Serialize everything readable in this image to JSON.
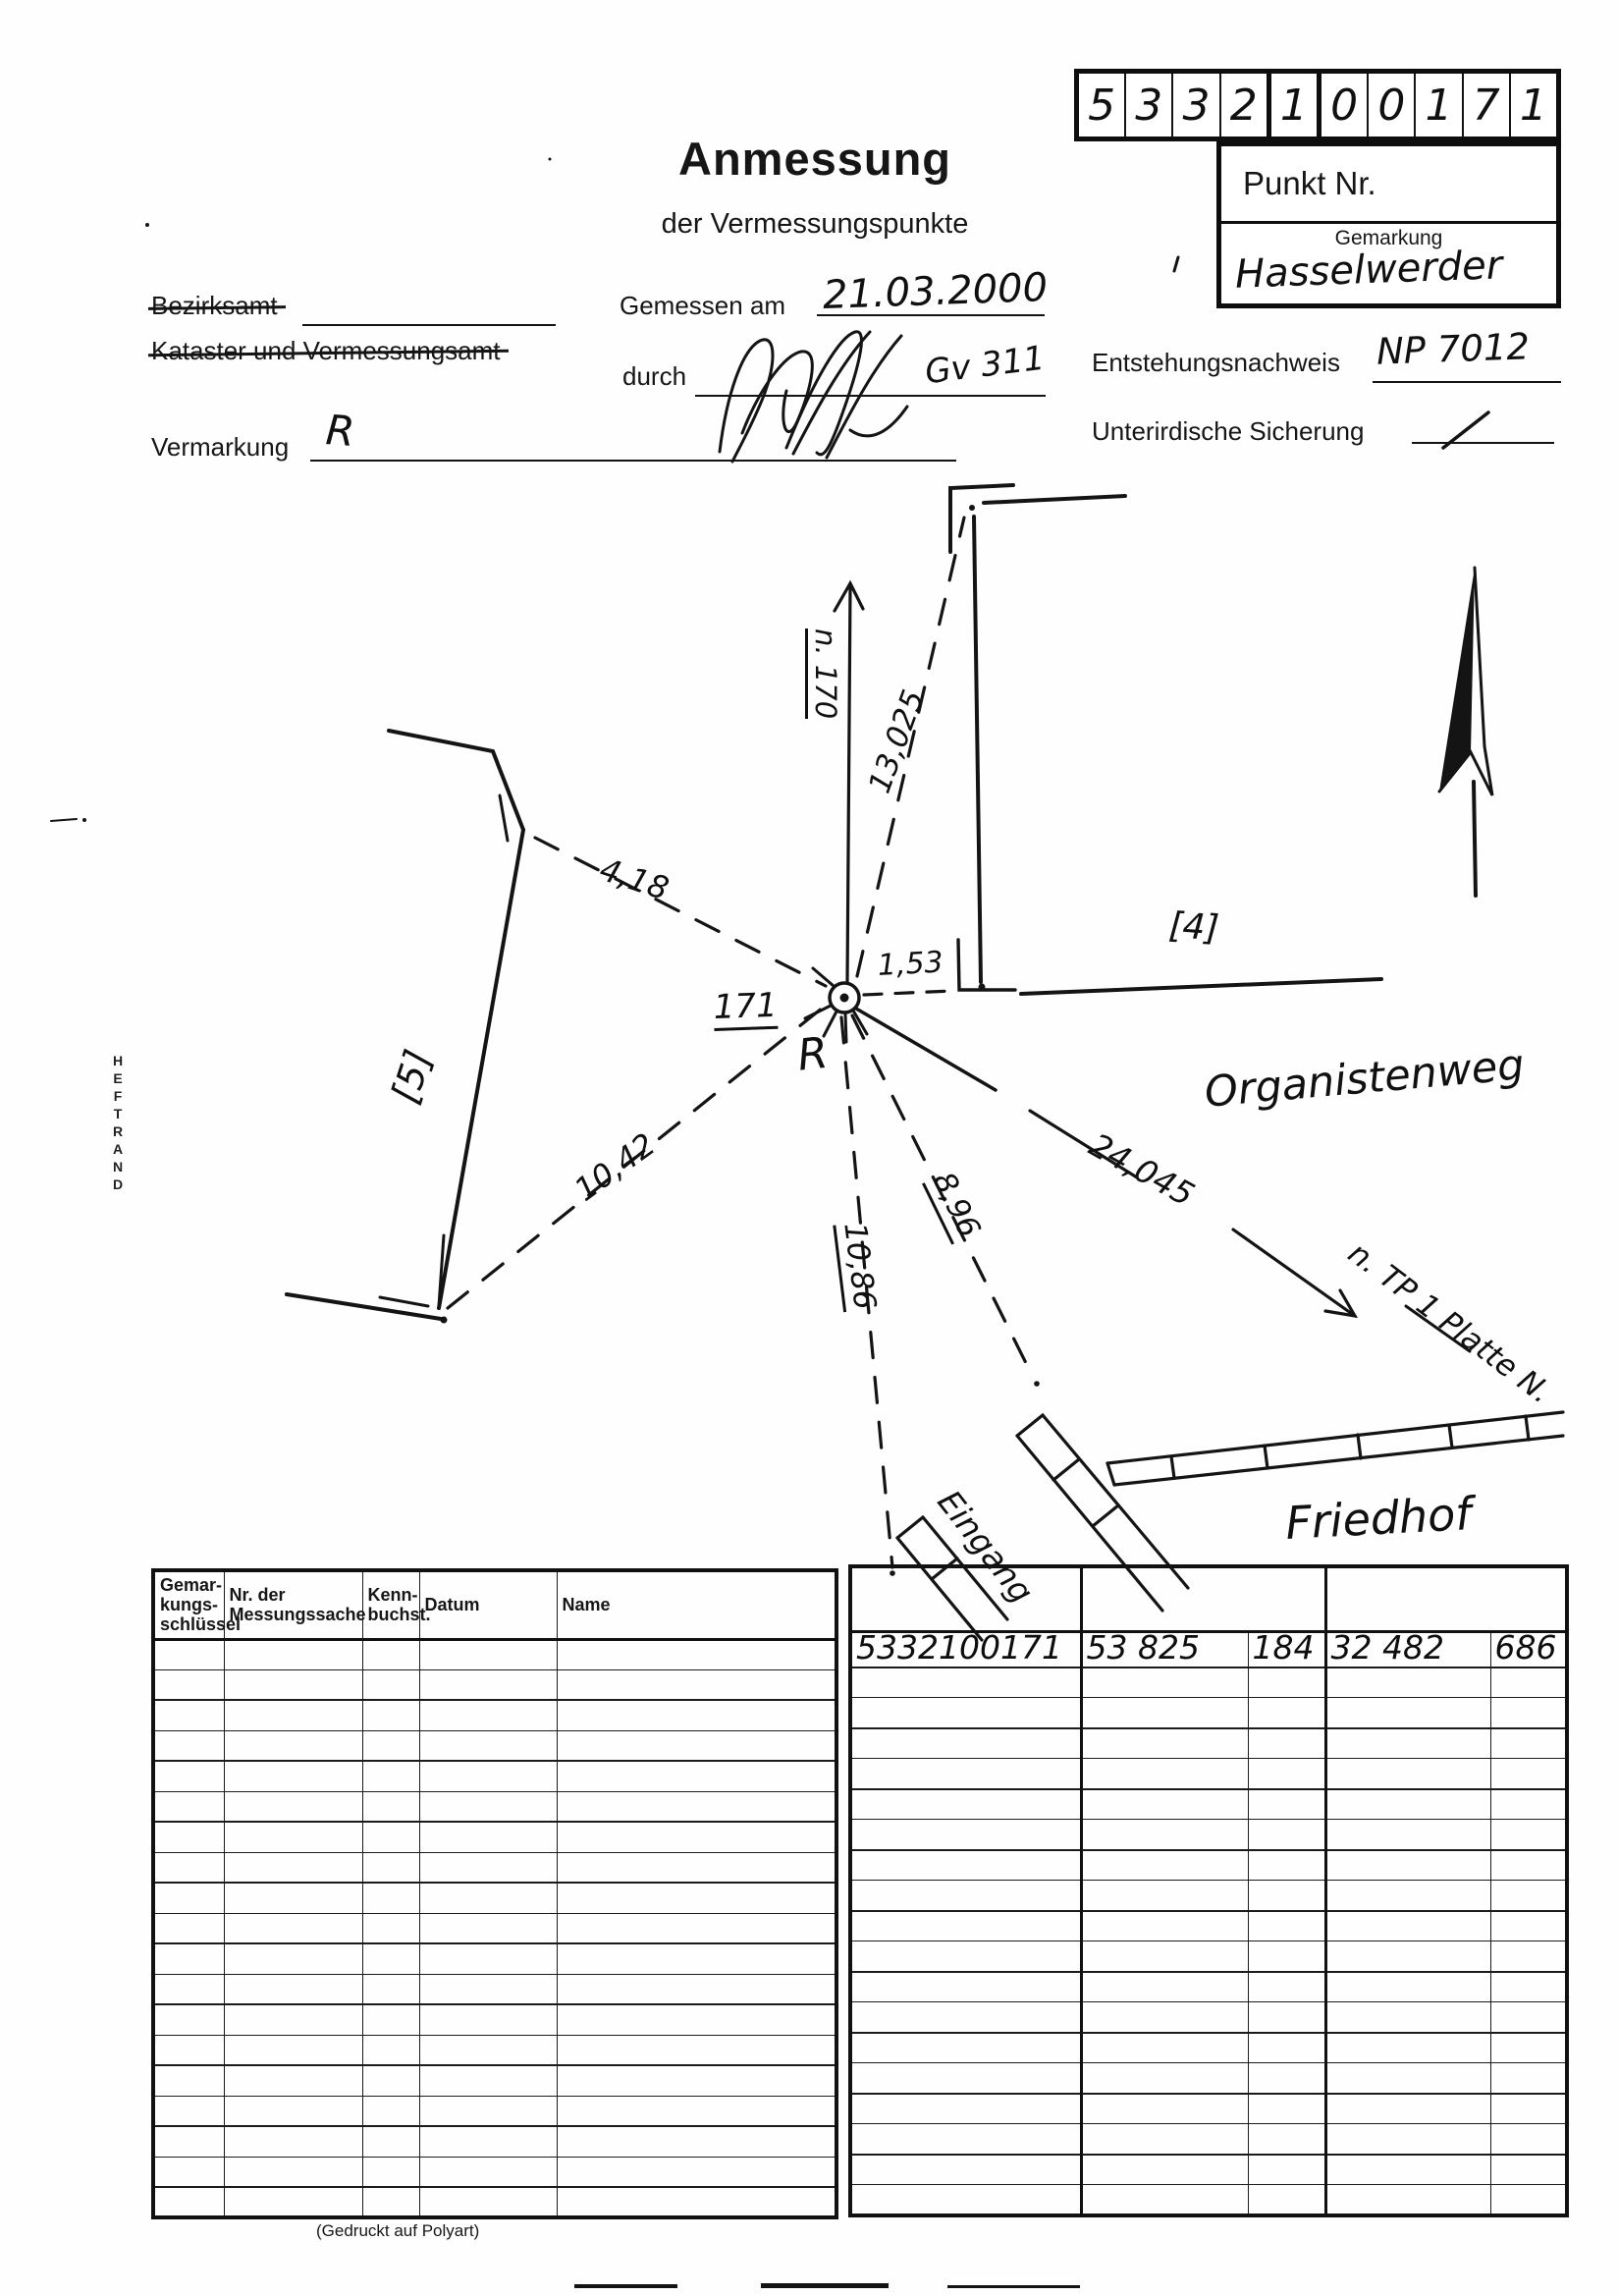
{
  "form": {
    "title": "Anmessung",
    "subtitle": "der Vermessungspunkte",
    "printed_on": "(Gedruckt auf Polyart)",
    "margin_text": "HEFTRAND"
  },
  "punkt": {
    "digits": [
      "5",
      "3",
      "3",
      "2",
      "1",
      "0",
      "0",
      "1",
      "7",
      "1"
    ],
    "label": "Punkt Nr.",
    "gemarkung_label": "Gemarkung",
    "gemarkung_value": "Hasselwerder"
  },
  "fields": {
    "bezirksamt": "Bezirksamt",
    "kataster": "Kataster und Vermessungsamt",
    "gemessen_am_label": "Gemessen am",
    "gemessen_am_value": "21.03.2000",
    "durch_label": "durch",
    "durch_value": "Gv 311",
    "vermarkung_label": "Vermarkung",
    "vermarkung_value": "R",
    "entstehungsnachweis_label": "Entstehungsnachweis",
    "entstehungsnachweis_value": "NP 7012",
    "unterirdische_label": "Unterirdische Sicherung",
    "unterirdische_value": "/"
  },
  "sketch": {
    "point_number": "171",
    "point_mark": "R",
    "bearing_n170": "n. 170",
    "d_13_025": "13,025",
    "d_1_53": "1,53",
    "d_4_18": "4,18",
    "d_10_42": "10,42",
    "d_8_96": "8,96",
    "d_10_86": "10,86",
    "d_24_045": "24,045",
    "building_4": "[4]",
    "building_5": "[5]",
    "street": "Organistenweg",
    "to_tp1": "n. TP 1 Platte N.",
    "entrance": "Eingang",
    "cemetery": "Friedhof"
  },
  "tables": {
    "left": {
      "headers": [
        "Gemar-\nkungs-\nschlüssel",
        "Nr. der\nMessungssache",
        "Kenn-\nbuchst.",
        "Datum",
        "Name"
      ],
      "empty_rows": 19
    },
    "right": {
      "row1": [
        "5332100171",
        "53 825",
        "184",
        "32 482",
        "686"
      ],
      "empty_rows": 18
    }
  },
  "colors": {
    "ink": "#141414",
    "paper": "#fefefe"
  }
}
